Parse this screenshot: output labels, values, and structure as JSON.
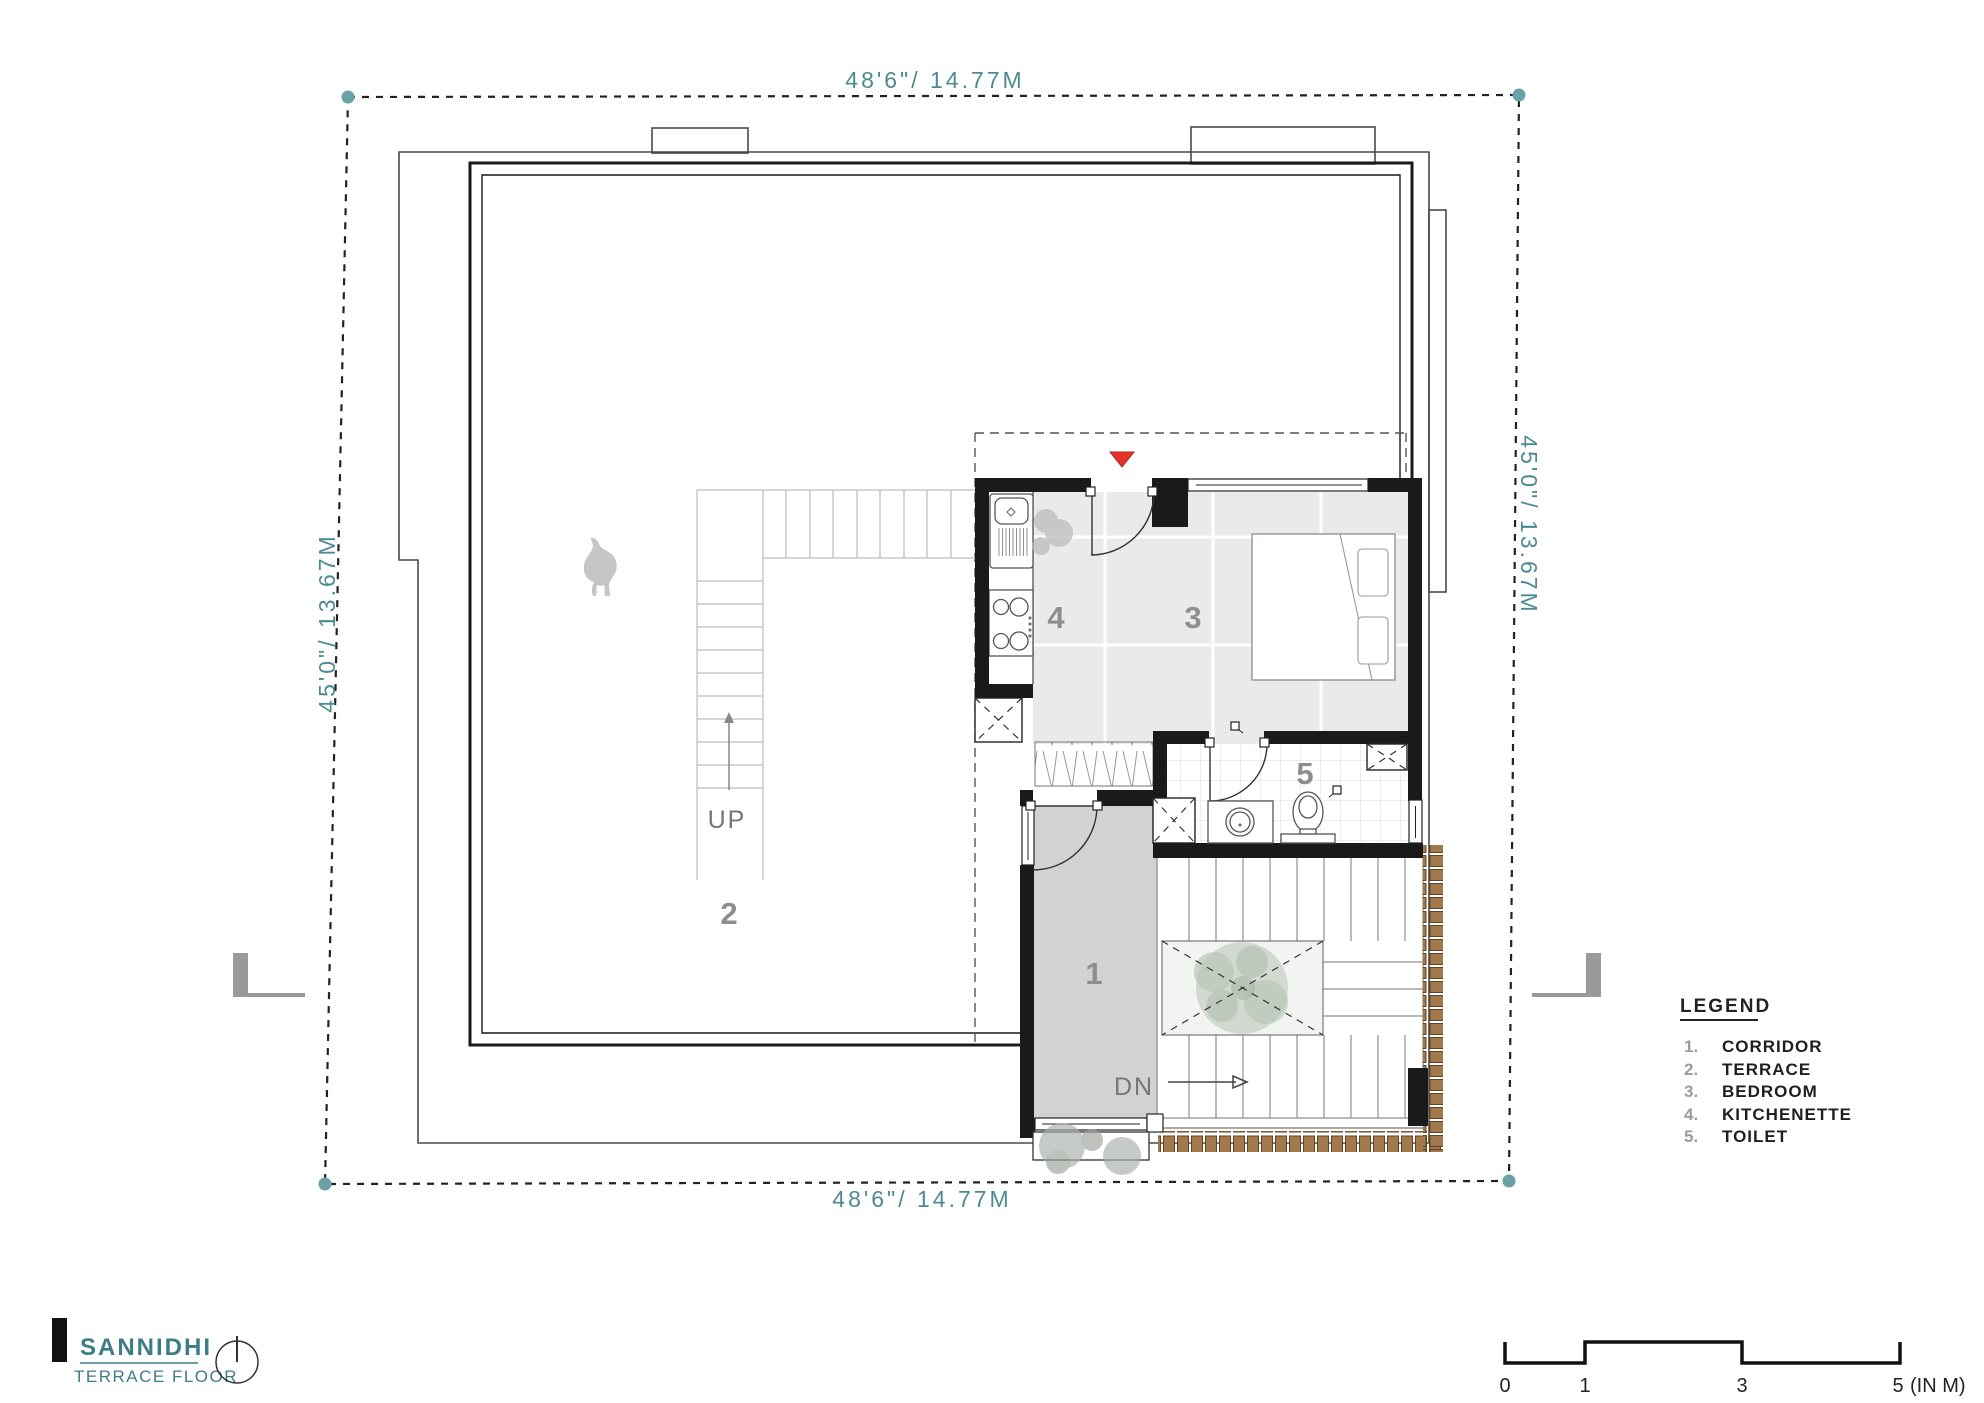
{
  "project": {
    "name": "SANNIDHI",
    "floor": "TERRACE FLOOR"
  },
  "dimensions": {
    "top": "48'6\"/ 14.77M",
    "bottom": "48'6\"/ 14.77M",
    "left": "45'0\"/ 13.67M",
    "right": "45'0\"/ 13.67M"
  },
  "plan_labels": {
    "corridor_number": "1",
    "terrace_number": "2",
    "bedroom_number": "3",
    "kitchenette_number": "4",
    "toilet_number": "5",
    "stair_up": "UP",
    "stair_down": "DN"
  },
  "legend": {
    "header": "LEGEND",
    "items": [
      {
        "num": "1.",
        "label": "CORRIDOR"
      },
      {
        "num": "2.",
        "label": "TERRACE"
      },
      {
        "num": "3.",
        "label": "BEDROOM"
      },
      {
        "num": "4.",
        "label": "KITCHENETTE"
      },
      {
        "num": "5.",
        "label": "TOILET"
      }
    ]
  },
  "scale_bar": {
    "tick_0": "0",
    "tick_1": "1",
    "tick_3": "3",
    "tick_5": "5",
    "unit": "(IN M)"
  },
  "colors": {
    "accent_teal": "#4d8b92",
    "marker_red": "#e5332a",
    "brick_brown": "#a3794b"
  }
}
